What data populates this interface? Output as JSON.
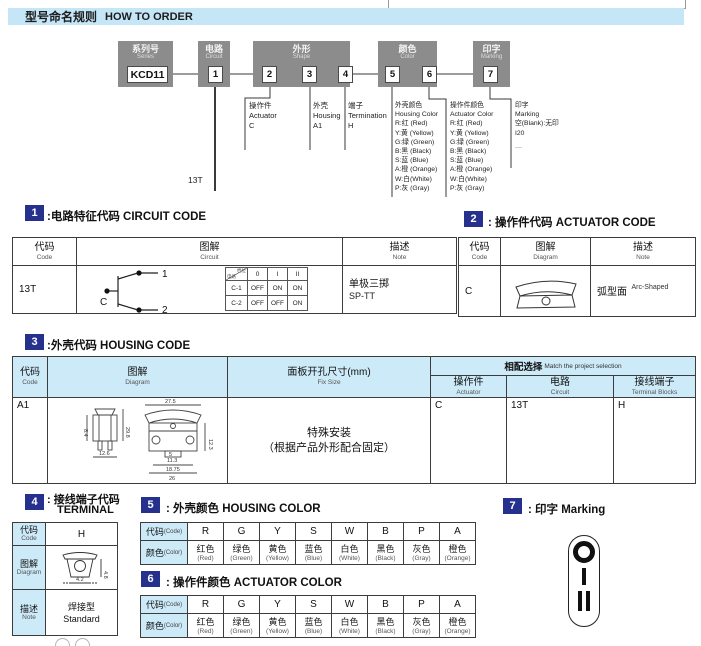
{
  "header": {
    "zh": "型号命名规则",
    "en": "HOW TO ORDER"
  },
  "diagram": {
    "groups": [
      {
        "zh": "系列号",
        "en": "Series",
        "codes": [
          "KCD11"
        ]
      },
      {
        "zh": "电路",
        "en": "Circuit",
        "codes": [
          "1"
        ]
      },
      {
        "zh": "外形",
        "en": "Shape",
        "codes": [
          "2",
          "3",
          "4"
        ]
      },
      {
        "zh": "颜色",
        "en": "Color",
        "codes": [
          "5",
          "6"
        ]
      },
      {
        "zh": "印字",
        "en": "Marking",
        "codes": [
          "7"
        ]
      }
    ],
    "ann": {
      "circuit_code": "13T",
      "actuator": {
        "zh": "操作件",
        "en": "Actuator",
        "code": "C"
      },
      "housing": {
        "zh": "外壳",
        "en": "Housing",
        "code": "A1"
      },
      "termination": {
        "zh": "端子",
        "en": "Termination",
        "code": "H"
      },
      "housing_color": {
        "zh": "外壳颜色",
        "en": "Housing Color"
      },
      "actuator_color": {
        "zh": "操作件颜色",
        "en": "Actuator Color"
      },
      "color_items": [
        "R:红 (Red)",
        "Y:黄 (Yellow)",
        "G:绿 (Green)",
        "B:黑 (Black)",
        "S:蓝 (Blue)",
        "A:橙 (Orange)",
        "W:白(White)",
        "P:灰 (Gray)"
      ],
      "marking": {
        "zh": "印字",
        "en": "Marking",
        "blank": "空(Blank):无印",
        "code": "I20",
        "more": "—"
      }
    }
  },
  "sec1": {
    "num": "1",
    "title": ":电路特征代码 CIRCUIT CODE",
    "h": {
      "code_zh": "代码",
      "code_en": "Code",
      "dia_zh": "图解",
      "dia_en": "Circuit",
      "note_zh": "描述",
      "note_en": "Note"
    },
    "code": "13T",
    "note_zh": "单极三掷",
    "note_en": "SP-TT",
    "circuit": {
      "pole": "C",
      "c1": "1",
      "c2": "2",
      "st": {
        "corner_a": "档位",
        "corner_b": "电路",
        "cols": [
          "0",
          "I",
          "II"
        ],
        "r1": [
          "C-1",
          "OFF",
          "ON",
          "ON"
        ],
        "r2": [
          "C-2",
          "OFF",
          "OFF",
          "ON"
        ]
      }
    }
  },
  "sec2": {
    "num": "2",
    "title": ": 操作件代码 ACTUATOR CODE",
    "h": {
      "code_zh": "代码",
      "code_en": "Code",
      "dia_zh": "图解",
      "dia_en": "Diagram",
      "note_zh": "描述",
      "note_en": "Note"
    },
    "code": "C",
    "note_zh": "弧型面",
    "note_en": "Arc-Shaped"
  },
  "sec3": {
    "num": "3",
    "title": ":外壳代码 HOUSING CODE",
    "h": {
      "code_zh": "代码",
      "code_en": "Code",
      "dia_zh": "图解",
      "dia_en": "Diagram",
      "fix_zh": "面板开孔尺寸(mm)",
      "fix_en": "Fix Size",
      "match_zh": "相配选择",
      "match_en": "Match the project selection",
      "act_zh": "操作件",
      "act_en": "Actuator",
      "cir_zh": "电路",
      "cir_en": "Circuit",
      "term_zh": "接线端子",
      "term_en": "Terminal Blocks"
    },
    "code": "A1",
    "fix1": "特殊安装",
    "fix2": "（根据产品外形配合固定）",
    "act": "C",
    "cir": "13T",
    "term": "H",
    "dims": {
      "d1": "27.5",
      "d2": "29.8",
      "d3": "12.6",
      "d4": "26",
      "d5": "18.75",
      "d6": "12.3",
      "d7": "5",
      "d8": "11.3",
      "d9": "8.4"
    }
  },
  "sec4": {
    "num": "4",
    "title1": ": 接线端子代码",
    "title2": "TERMINAL",
    "h": {
      "code_zh": "代码",
      "code_en": "Code",
      "dia_zh": "图解",
      "dia_en": "Diagram",
      "note_zh": "描述",
      "note_en": "Note"
    },
    "code": "H",
    "note_zh": "焊接型",
    "note_en": "Standard",
    "dims": {
      "h": "4.8",
      "w": "4.2"
    }
  },
  "sec5": {
    "num": "5",
    "title": ": 外壳颜色 HOUSING COLOR"
  },
  "sec6": {
    "num": "6",
    "title": ": 操作件颜色 ACTUATOR COLOR"
  },
  "sec7": {
    "num": "7",
    "title": ": 印字 Marking"
  },
  "color_table": {
    "code_label_zh": "代码",
    "code_label_en": "(Code)",
    "name_label_zh": "颜色",
    "name_label_en": "(Color)",
    "codes": [
      "R",
      "G",
      "Y",
      "S",
      "W",
      "B",
      "P",
      "A"
    ],
    "zh": [
      "红色",
      "绿色",
      "黄色",
      "蓝色",
      "白色",
      "黑色",
      "灰色",
      "橙色"
    ],
    "en": [
      "(Red)",
      "(Green)",
      "(Yellow)",
      "(Blue)",
      "(White)",
      "(Black)",
      "(Gray)",
      "(Orange)"
    ]
  },
  "colors": {
    "accent_blue": "#c5e6f7",
    "table_blue": "#cdeaf8",
    "badge_navy": "#26318e",
    "box_gray": "#8c8c8c"
  }
}
